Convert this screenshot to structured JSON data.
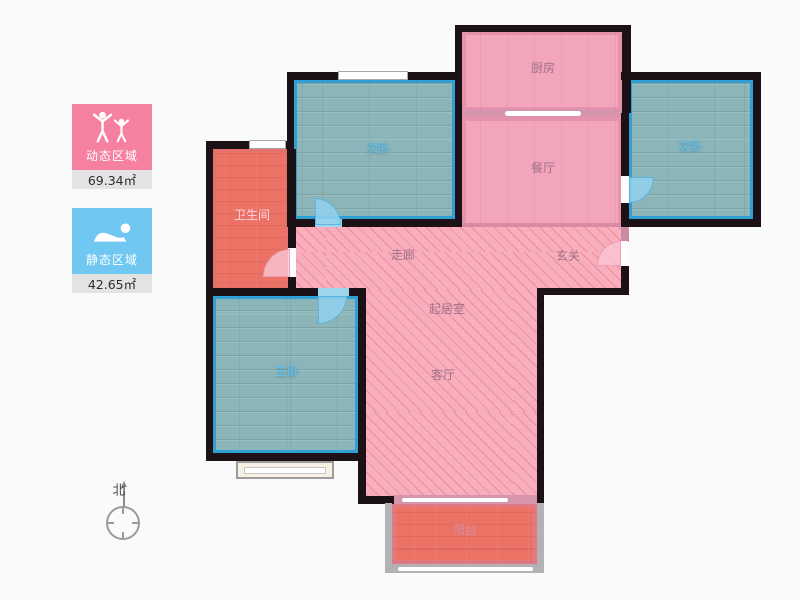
{
  "legend": {
    "dynamic": {
      "label": "动态区域",
      "area": "69.34㎡",
      "color": "#f580a0",
      "icon": "cheering-people-icon"
    },
    "static": {
      "label": "静态区域",
      "area": "42.65㎡",
      "color": "#70c8f2",
      "icon": "sleeping-person-icon"
    }
  },
  "compass": {
    "north_label": "北"
  },
  "rooms": {
    "kitchen": {
      "label": "厨房",
      "zone": "dynamic"
    },
    "dining": {
      "label": "餐厅",
      "zone": "dynamic"
    },
    "bedroom_left": {
      "label": "次卧",
      "zone": "static"
    },
    "bedroom_right": {
      "label": "次卧",
      "zone": "static"
    },
    "master": {
      "label": "主卧",
      "zone": "static"
    },
    "bathroom": {
      "label": "卫生间",
      "zone": "wet"
    },
    "corridor": {
      "label": "走廊",
      "zone": "dynamic"
    },
    "entry": {
      "label": "玄关",
      "zone": "dynamic"
    },
    "living": {
      "label": "起居室",
      "zone": "dynamic"
    },
    "parlor": {
      "label": "客厅",
      "zone": "dynamic"
    },
    "balcony": {
      "label": "阳台",
      "zone": "dynamic"
    }
  },
  "colors": {
    "dynamic_pink": "#f580a0",
    "static_blue": "#70c8f2",
    "floor_pink": "#f2a5bb",
    "floor_hatch": "#f9aebc",
    "floor_teal": "#8cb5b9",
    "floor_red": "#ec7266",
    "wall": "#1b1116",
    "room_border_blue": "#2f9fd4"
  }
}
